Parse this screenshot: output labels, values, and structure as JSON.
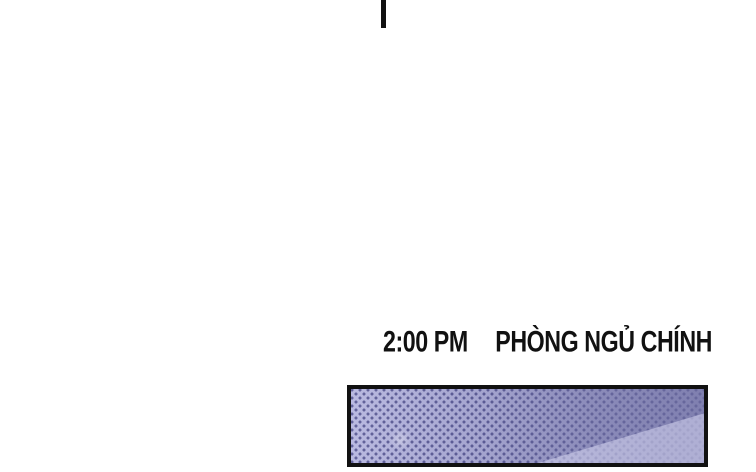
{
  "caption": {
    "time": "2:00 PM",
    "location": "PHÒNG NGỦ CHÍNH"
  },
  "colors": {
    "ink": "#111111",
    "page-bg": "#ffffff",
    "panel-left": "#b9b9e0",
    "panel-mid": "#9a9ac6",
    "panel-right": "#8080b0",
    "dot": "rgba(46,46,112,0.62)",
    "diag": "rgba(214,214,240,0.55)"
  }
}
